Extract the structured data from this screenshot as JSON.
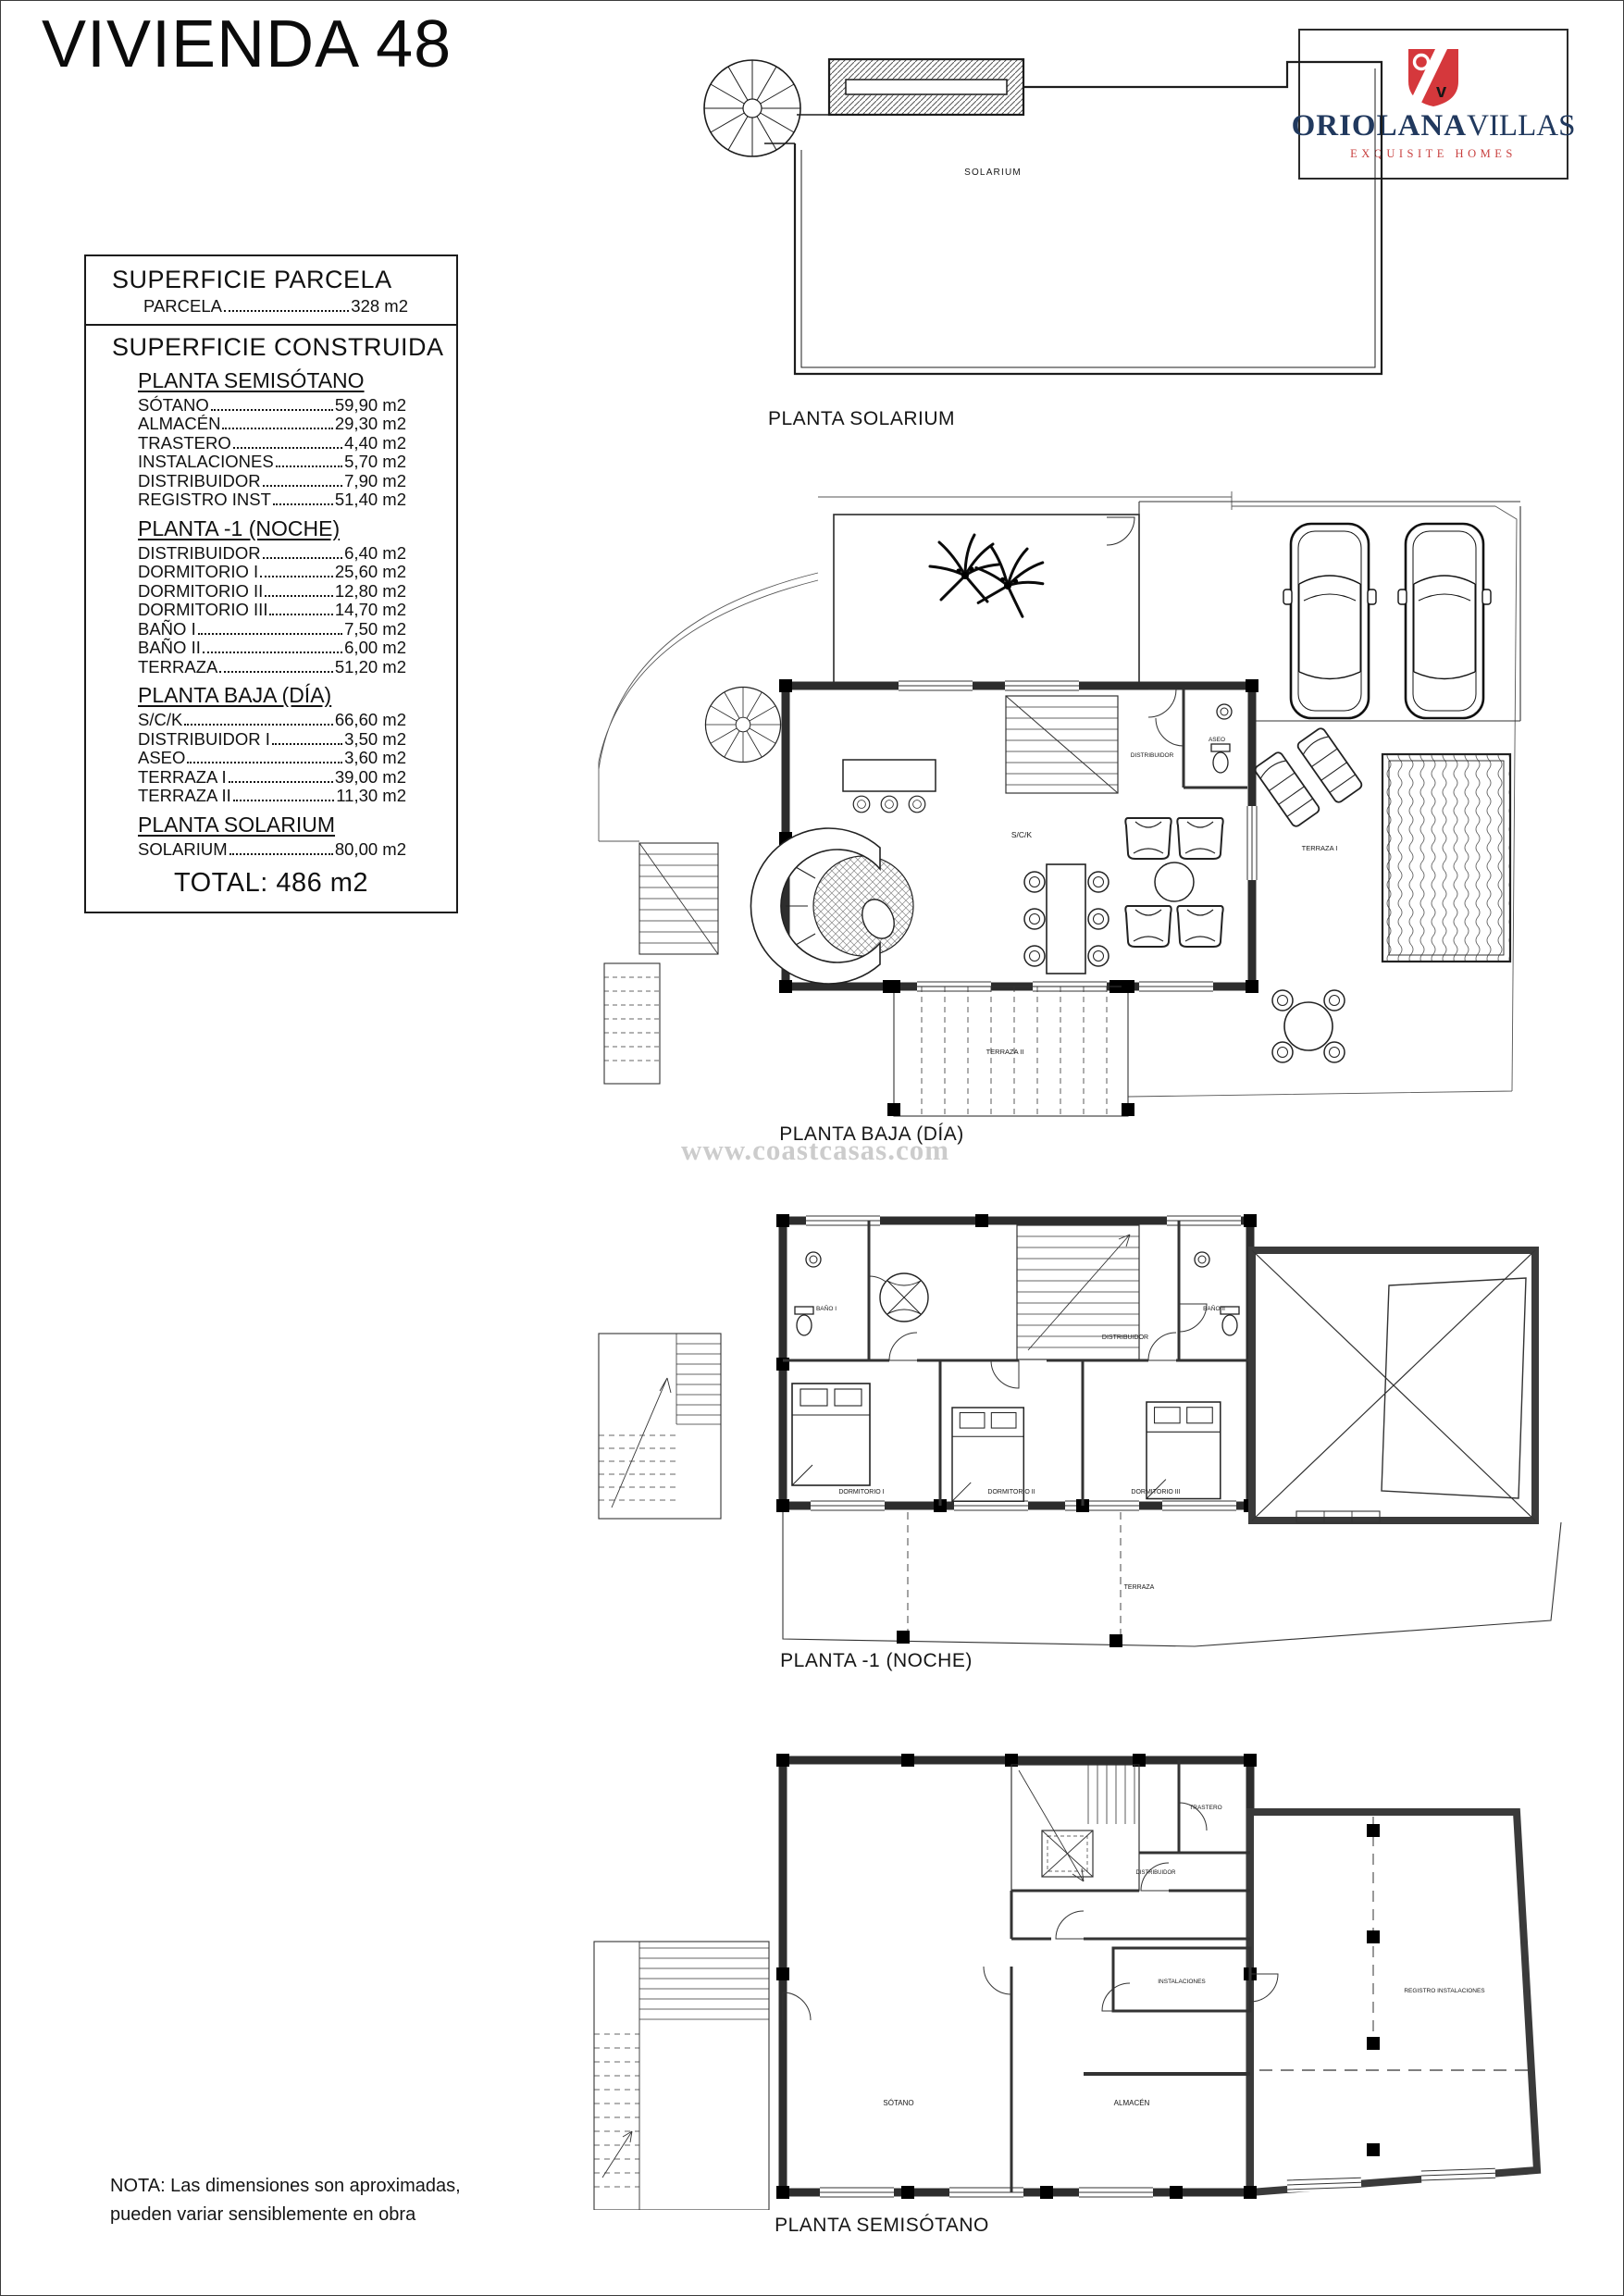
{
  "page": {
    "title": "VIVIENDA 48",
    "watermark": "www.coastcasas.com",
    "note_line1": "NOTA: Las dimensiones son aproximadas,",
    "note_line2": "pueden variar sensiblemente en obra"
  },
  "logo": {
    "brand_bold": "ORIOLANA",
    "brand_light": "VILLAS",
    "tagline": "EXQUISITE HOMES",
    "shield_letter": "v",
    "navy": "#21395e",
    "red": "#d5383c"
  },
  "surface_table": {
    "parcela_heading": "SUPERFICIE PARCELA",
    "parcela_row": {
      "label": "PARCELA",
      "value": "328 m2"
    },
    "construida_heading": "SUPERFICIE CONSTRUIDA",
    "groups": [
      {
        "heading": "PLANTA SEMISÓTANO",
        "rows": [
          {
            "label": "SÓTANO",
            "value": "59,90 m2"
          },
          {
            "label": "ALMACÉN",
            "value": "29,30 m2"
          },
          {
            "label": "TRASTERO",
            "value": "4,40 m2"
          },
          {
            "label": "INSTALACIONES",
            "value": "5,70 m2"
          },
          {
            "label": "DISTRIBUIDOR",
            "value": "7,90 m2"
          },
          {
            "label": "REGISTRO INST",
            "value": "51,40 m2"
          }
        ]
      },
      {
        "heading": "PLANTA -1 (NOCHE)",
        "rows": [
          {
            "label": "DISTRIBUIDOR",
            "value": "6,40 m2"
          },
          {
            "label": "DORMITORIO I",
            "value": "25,60 m2"
          },
          {
            "label": "DORMITORIO II",
            "value": "12,80 m2"
          },
          {
            "label": "DORMITORIO III",
            "value": "14,70 m2"
          },
          {
            "label": "BAÑO I",
            "value": "7,50 m2"
          },
          {
            "label": "BAÑO II",
            "value": "6,00 m2"
          },
          {
            "label": "TERRAZA",
            "value": "51,20 m2"
          }
        ]
      },
      {
        "heading": "PLANTA BAJA (DÍA)",
        "rows": [
          {
            "label": "S/C/K",
            "value": "66,60 m2"
          },
          {
            "label": "DISTRIBUIDOR I",
            "value": "3,50 m2"
          },
          {
            "label": "ASEO",
            "value": "3,60 m2"
          },
          {
            "label": "TERRAZA I",
            "value": "39,00 m2"
          },
          {
            "label": "TERRAZA II",
            "value": "11,30 m2"
          }
        ]
      },
      {
        "heading": "PLANTA SOLARIUM",
        "rows": [
          {
            "label": "SOLARIUM",
            "value": "80,00 m2"
          }
        ]
      }
    ],
    "total": "TOTAL: 486 m2"
  },
  "plans": {
    "solarium": {
      "caption": "PLANTA SOLARIUM",
      "rooms": {
        "solarium": "SOLARIUM"
      }
    },
    "baja": {
      "caption": "PLANTA BAJA (DÍA)",
      "rooms": {
        "sck": "S/C/K",
        "distribuidor": "DISTRIBUIDOR",
        "aseo": "ASEO",
        "terraza1": "TERRAZA I",
        "terraza2": "TERRAZA II"
      }
    },
    "noche": {
      "caption": "PLANTA -1 (NOCHE)",
      "rooms": {
        "bano1": "BAÑO I",
        "bano2": "BAÑO II",
        "distribuidor": "DISTRIBUIDOR",
        "dorm1": "DORMITORIO I",
        "dorm2": "DORMITORIO II",
        "dorm3": "DORMITORIO III",
        "terraza": "TERRAZA"
      }
    },
    "semisotano": {
      "caption": "PLANTA SEMISÓTANO",
      "rooms": {
        "trastero": "TRASTERO",
        "distribuidor": "DISTRIBUIDOR",
        "instalaciones": "INSTALACIONES",
        "sotano": "SÓTANO",
        "almacen": "ALMACÉN",
        "registro": "REGISTRO INSTALACIONES"
      }
    }
  }
}
